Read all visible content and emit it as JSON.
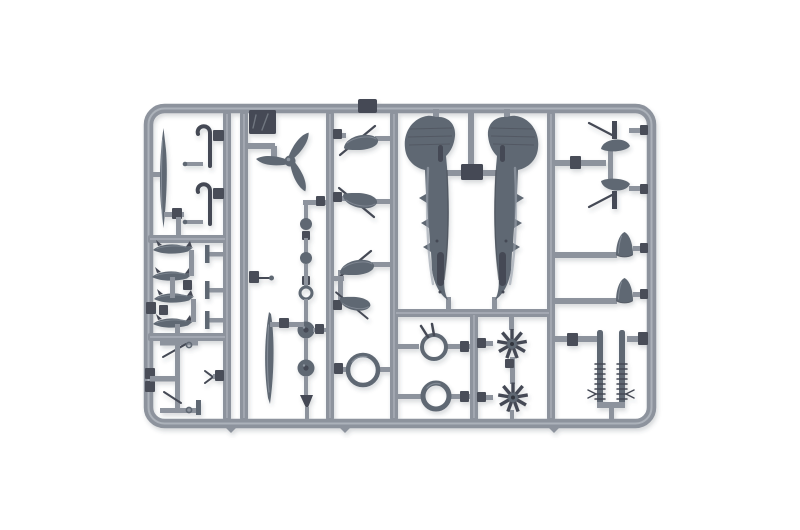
{
  "meta": {
    "description": "Photograph of a grey injection-moulded plastic model aircraft kit sprue (runner frame) with unassembled parts, on a plain white background",
    "object": "model-kit-sprue",
    "plastic_shade": "blue-grey"
  },
  "colors": {
    "background": "#ffffff",
    "runner": "#8d939d",
    "runner-light": "#b2b7bf",
    "runner-dark": "#6b717b",
    "part": "#5f6873",
    "part-light": "#9aa1ac",
    "part-dark": "#454a54",
    "gate": "#494e58",
    "shadow": "#3a414d"
  },
  "sprue": {
    "parts": [
      {
        "id": "fuselage-half",
        "label": "Aircraft fuselage half",
        "count": 2
      },
      {
        "id": "propeller",
        "label": "Three-blade propeller",
        "count": 1
      },
      {
        "id": "radial-engine",
        "label": "Radial engine face",
        "count": 2
      },
      {
        "id": "cowl-ring",
        "label": "Large cowl ring",
        "count": 1
      },
      {
        "id": "intake-ring",
        "label": "Small round ring",
        "count": 3
      },
      {
        "id": "wheel",
        "label": "Wheel",
        "count": 2
      },
      {
        "id": "ball-part",
        "label": "Small ball part",
        "count": 2
      },
      {
        "id": "spat-half",
        "label": "Wheel spat half",
        "count": 4
      },
      {
        "id": "spinner-cone",
        "label": "Cone / spinner",
        "count": 2
      },
      {
        "id": "tail-wheel",
        "label": "Tail wheel assembly",
        "count": 2
      },
      {
        "id": "exhaust-strip",
        "label": "Ribbed exhaust strip",
        "count": 2
      },
      {
        "id": "bomb",
        "label": "Small bomb / tank",
        "count": 4
      },
      {
        "id": "gear-door-strut",
        "label": "Landing gear door with strut",
        "count": 2
      },
      {
        "id": "blade-strut",
        "label": "Blade-shaped strut",
        "count": 2
      },
      {
        "id": "hook-strut",
        "label": "Hooked strut",
        "count": 2
      },
      {
        "id": "t-bulkhead",
        "label": "Small T bulkhead",
        "count": 3
      },
      {
        "id": "sprue-tag",
        "label": "Moulded sprue tag",
        "count": 1
      }
    ]
  }
}
